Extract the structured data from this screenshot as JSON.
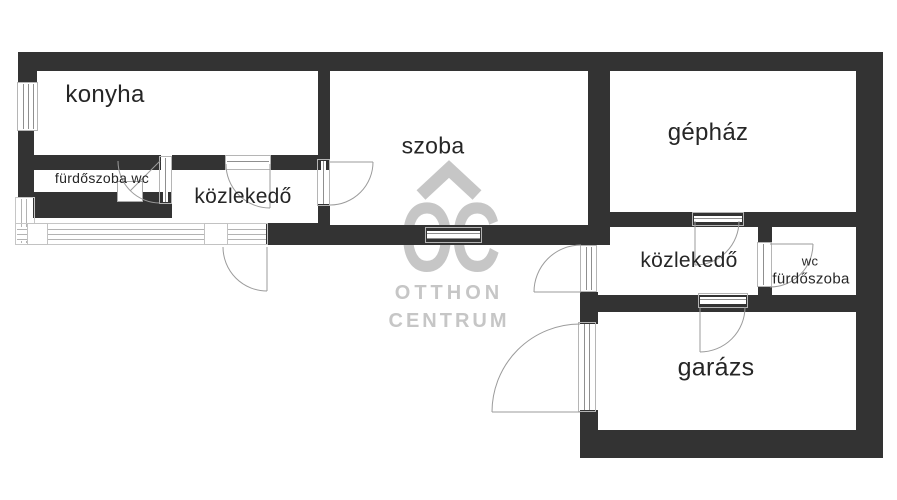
{
  "plan": {
    "rooms": {
      "konyha": "konyha",
      "szoba": "szoba",
      "gephaz": "gépház",
      "kozlekedo_left": "közlekedő",
      "furdoszoba_wc": "fürdőszoba wc",
      "kozlekedo_right": "közlekedő",
      "wc": "wc",
      "furdoszoba": "fürdőszoba",
      "garazs": "garázs"
    },
    "watermark": {
      "monogram": "OC",
      "line1": "OTTHON",
      "line2": "CENTRUM"
    },
    "colors": {
      "wall": "#333333",
      "frame": "#b5b5b5",
      "swing_line": "#9b9b9b",
      "watermark": "#c6c6c6",
      "label": "#262626",
      "background": "#ffffff"
    }
  }
}
